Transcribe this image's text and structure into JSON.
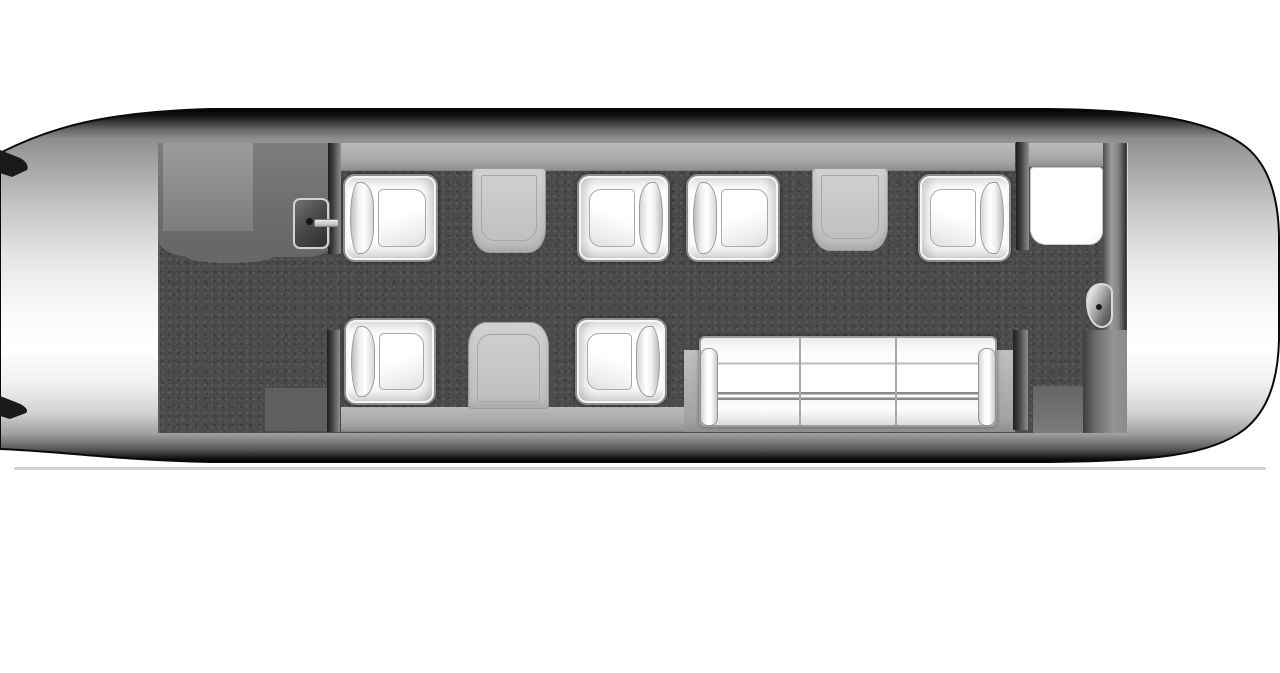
{
  "page": {
    "background": "#ffffff"
  },
  "diagram": {
    "type": "floorplan",
    "subject": "business jet cabin seating layout, top view, nose left and tail right",
    "capacity": {
      "club_seats": 6,
      "divan_seats": 3,
      "tables": 3
    },
    "palette": {
      "fuselage_edge": "#060606",
      "fuselage_highlight": "#ffffff",
      "carpet": "#4b4b4b",
      "sidewall_ledge": "#a8a8a8",
      "galley": "#707070",
      "table": "#c6c6c6",
      "seat_upholstery": "#ffffff",
      "partition_dark": "#2a2a2a",
      "ground_shadow": "#d2d2d2"
    },
    "items": [
      {
        "id": "cabin-carpet",
        "kind": "carpet",
        "x": 158,
        "y": 143,
        "w": 969,
        "h": 290
      },
      {
        "id": "forward-galley-area",
        "kind": "galley",
        "x": 158,
        "y": 143,
        "w": 174,
        "h": 114
      },
      {
        "id": "galley-counter-panel",
        "kind": "galley-panel",
        "x": 163,
        "y": 143,
        "w": 90,
        "h": 88
      },
      {
        "id": "sidewall-ledge-top",
        "kind": "strip",
        "x": 341,
        "y": 143,
        "w": 674,
        "h": 28
      },
      {
        "id": "sidewall-ledge-top-aft",
        "kind": "strip",
        "x": 1029,
        "y": 143,
        "w": 76,
        "h": 24
      },
      {
        "id": "sidewall-ledge-bottom",
        "kind": "strip",
        "x": 341,
        "y": 407,
        "w": 350,
        "h": 25
      },
      {
        "id": "divan-platform",
        "kind": "platform",
        "x": 684,
        "y": 350,
        "w": 331,
        "h": 82
      },
      {
        "id": "entry-floor-pad",
        "kind": "pad",
        "x": 265,
        "y": 388,
        "w": 63,
        "h": 43
      },
      {
        "id": "aft-floor-pad",
        "kind": "pad pad-aft",
        "x": 1033,
        "y": 386,
        "w": 51,
        "h": 47
      },
      {
        "id": "forward-partition-top",
        "kind": "divider",
        "x": 328,
        "y": 143,
        "w": 13,
        "h": 111
      },
      {
        "id": "forward-partition-bottom",
        "kind": "divider",
        "x": 327,
        "y": 330,
        "w": 13,
        "h": 102
      },
      {
        "id": "aft-partition-top",
        "kind": "divider",
        "x": 1016,
        "y": 142,
        "w": 13,
        "h": 108
      },
      {
        "id": "aft-partition-bottom",
        "kind": "divider",
        "x": 1013,
        "y": 330,
        "w": 15,
        "h": 100
      },
      {
        "id": "aft-bulkhead",
        "kind": "bulkhead",
        "x": 1103,
        "y": 143,
        "w": 24,
        "h": 190
      },
      {
        "id": "aft-closet",
        "kind": "closet",
        "x": 1083,
        "y": 330,
        "w": 44,
        "h": 103
      },
      {
        "id": "aft-cabinet",
        "kind": "cabinet",
        "x": 1030,
        "y": 167,
        "w": 73,
        "h": 78
      },
      {
        "id": "galley-monitor-panel",
        "kind": "monitor",
        "x": 293,
        "y": 198,
        "w": 36,
        "h": 51
      },
      {
        "id": "table-forward-club",
        "kind": "table table-top",
        "x": 472,
        "y": 168,
        "w": 74,
        "h": 85
      },
      {
        "id": "table-mid-club",
        "kind": "table table-top",
        "x": 812,
        "y": 168,
        "w": 76,
        "h": 83
      },
      {
        "id": "table-lower-club",
        "kind": "table table-bottom",
        "x": 468,
        "y": 322,
        "w": 81,
        "h": 87
      },
      {
        "id": "club-seat-1",
        "kind": "seat",
        "facing": "right",
        "x": 343,
        "y": 174,
        "w": 95,
        "h": 88
      },
      {
        "id": "club-seat-2",
        "kind": "seat",
        "facing": "left",
        "x": 577,
        "y": 174,
        "w": 93,
        "h": 88
      },
      {
        "id": "club-seat-3",
        "kind": "seat",
        "facing": "right",
        "x": 686,
        "y": 174,
        "w": 94,
        "h": 88
      },
      {
        "id": "club-seat-4",
        "kind": "seat",
        "facing": "left",
        "x": 918,
        "y": 174,
        "w": 93,
        "h": 88
      },
      {
        "id": "club-seat-5",
        "kind": "seat",
        "facing": "right",
        "x": 344,
        "y": 318,
        "w": 92,
        "h": 87
      },
      {
        "id": "club-seat-6",
        "kind": "seat",
        "facing": "left",
        "x": 575,
        "y": 318,
        "w": 92,
        "h": 87
      },
      {
        "id": "three-seat-divan",
        "kind": "couch",
        "x": 699,
        "y": 336,
        "w": 298,
        "h": 91
      },
      {
        "id": "lav-corner-seat",
        "kind": "wedge",
        "x": 1086,
        "y": 283,
        "w": 27,
        "h": 45
      }
    ]
  }
}
